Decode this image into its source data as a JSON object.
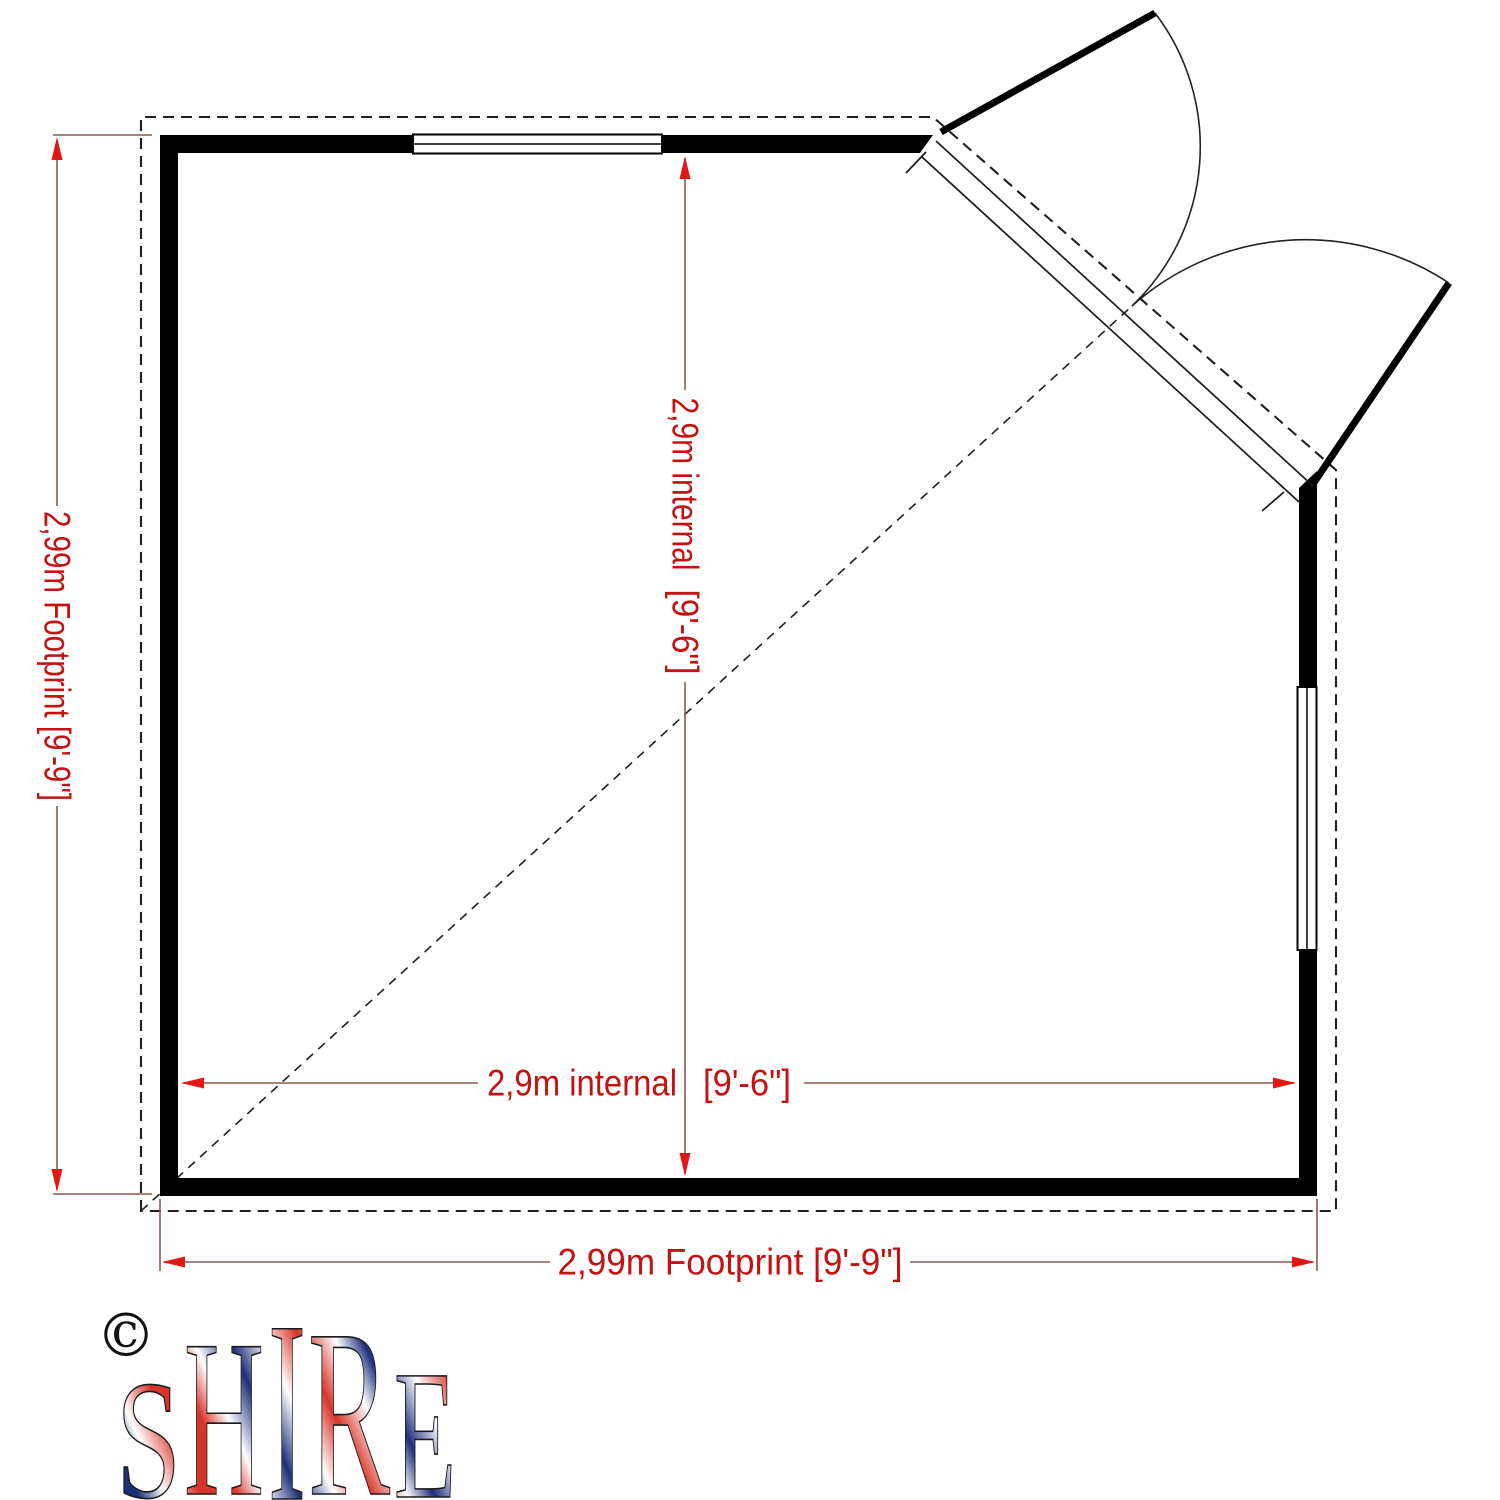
{
  "drawing_type": "garden-building-corner-floor-plan",
  "dimensions": {
    "left_footprint": "2,99m Footprint [9'-9\"]",
    "bottom_footprint": "2,99m Footprint [9'-9\"]",
    "vertical_internal_metric": "2,9m internal",
    "vertical_internal_imperial": "[9'-6\"]",
    "horizontal_internal_metric": "2,9m internal",
    "horizontal_internal_imperial": "[9'-6\"]"
  },
  "logo": {
    "copyright": "©",
    "letters": [
      "S",
      "H",
      "I",
      "R",
      "E"
    ]
  },
  "colors": {
    "dimension_text": "#c41212",
    "dimension_line": "#8a5a50",
    "arrow_red": "#e31515",
    "wall_black": "#000000",
    "flag_navy": "#1e2f7a",
    "flag_red": "#d8352a",
    "background": "#ffffff"
  }
}
